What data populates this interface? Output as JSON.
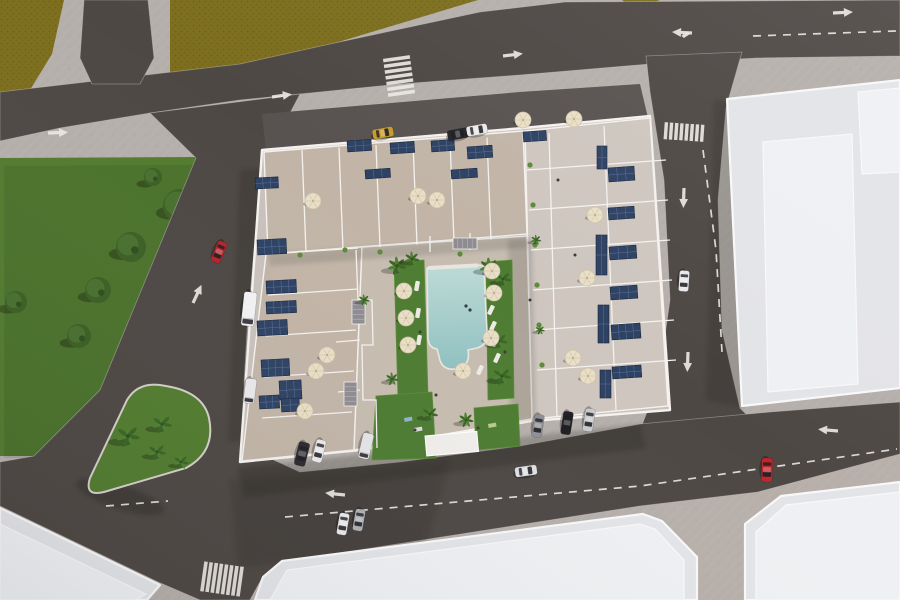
{
  "meta": {
    "type": "aerial-3d-architectural-render",
    "subject": "bird's-eye render of a residential apartment complex with rooftop solar panels, terraces, central pool courtyard, surrounding streets, parks and neighboring white buildings",
    "canvas": {
      "w": 900,
      "h": 600
    }
  },
  "palette": {
    "sidewalk": "#b5afab",
    "sidewalk_warm": "rgba(208,182,166,0.12)",
    "field": "#7d6f1e",
    "field_dark": "#6c6016",
    "park": "#527c30",
    "road": "#4e4845",
    "road_light": "#585250",
    "marking": "#eae8e4",
    "roof": "#e3e4e8",
    "roof_light": "#eef0f3",
    "parapet": "#f8f8f9",
    "complex_base": "#c9c2bc",
    "terrace": "#c2b5a8",
    "terrace_light": "#cec6bf",
    "deck": "#c6bcb0",
    "wall": "#f4f1ee",
    "solar": "#2e4263",
    "solar_line": "#5f77a0",
    "pool_light": "#bedad7",
    "pool_deep": "#8fc0c0",
    "lawn": "#4e7c32",
    "lawn_light": "#5c8b3a",
    "umbrella": "#e9dfc8",
    "umbrella_rib": "#d8cbae",
    "tree": "#3c6024",
    "tree_light": "#497030",
    "palm": "#4e8132",
    "palm_dark": "#3c6526"
  },
  "ground": {
    "fields": [
      "0,0 64,0 52,54 30,90 0,97",
      "170,0 478,0 332,44 250,64 196,76 170,82",
      "622,0 660,0 634,10"
    ],
    "park": "0,158 197,157 100,390 34,456 0,456",
    "trees": [
      [
        180,
        206,
        17
      ],
      [
        131,
        247,
        15
      ],
      [
        98,
        290,
        13
      ],
      [
        79,
        336,
        12
      ],
      [
        16,
        302,
        11
      ],
      [
        153,
        177,
        9
      ]
    ],
    "island": "M209,418 Q216,452 186,468 L104,492 Q84,497 90,478 L127,400 Q139,380 166,386 Q203,392 209,418 Z",
    "island_palms": [
      [
        128,
        436,
        1.25
      ],
      [
        162,
        424,
        1.05
      ],
      [
        157,
        452,
        0.95
      ],
      [
        181,
        462,
        0.8
      ]
    ],
    "warm_tint": "640,455 900,405 900,600 700,600"
  },
  "roads": {
    "surfaces": [
      "0,92 240,64 330,44 480,12 565,2 900,0 900,56 757,58 650,64 520,75 400,84 300,94 240,100 150,113 60,128 0,141",
      "84,0 148,0 154,58 140,84 92,84 80,58",
      "646,56 742,52 726,108 718,200 722,330 740,408 760,428 700,436 640,430 658,384 670,300 664,180 650,92",
      "150,113 196,158 100,390 34,456 0,462 0,506 158,582 200,600 250,600 262,578 282,562 640,506 758,492 900,454 900,402 770,412 640,424 520,446 400,462 300,472 252,450 243,400 247,330 254,250 268,155 300,94"
    ],
    "aprons": [
      "262,114 520,92 640,84 648,118 525,131 266,152"
    ],
    "dashes": [
      "M753,36 L896,31",
      "M703,150 L716,250 L722,352",
      "M285,517 L640,486 L897,449",
      "M106,506 L168,501"
    ],
    "arrows": [
      {
        "x": 48,
        "y": 133,
        "r": -2,
        "t": "s"
      },
      {
        "x": 272,
        "y": 97,
        "r": -8,
        "t": "s"
      },
      {
        "x": 503,
        "y": 56,
        "r": -7,
        "t": "s"
      },
      {
        "x": 833,
        "y": 13,
        "r": -3,
        "t": "s"
      },
      {
        "x": 692,
        "y": 33,
        "r": 183,
        "t": "f"
      },
      {
        "x": 258,
        "y": 186,
        "r": -65,
        "t": "s"
      },
      {
        "x": 193,
        "y": 303,
        "r": -65,
        "t": "s"
      },
      {
        "x": 684,
        "y": 188,
        "r": 92,
        "t": "s"
      },
      {
        "x": 688,
        "y": 352,
        "r": 92,
        "t": "s"
      },
      {
        "x": 345,
        "y": 495,
        "r": 186,
        "t": "s"
      },
      {
        "x": 838,
        "y": 431,
        "r": 185,
        "t": "s"
      }
    ],
    "crosswalks": [
      {
        "x": 399,
        "y": 76,
        "r": -8,
        "n": 7,
        "bl": 27,
        "bw": 3.6,
        "g": 2.2,
        "o": "h"
      },
      {
        "x": 684,
        "y": 132,
        "r": 4,
        "n": 8,
        "bl": 17,
        "bw": 3.4,
        "g": 1.8,
        "o": "v"
      },
      {
        "x": 222,
        "y": 579,
        "r": 8,
        "n": 8,
        "bl": 30,
        "bw": 3.6,
        "g": 1.6,
        "o": "v"
      }
    ]
  },
  "buildings": [
    {
      "id": "east-building",
      "pts": "727,99 900,80 900,388 742,406",
      "inner": [
        "763,142 852,134 858,384 768,392",
        "858,92 900,88 900,172 862,174"
      ]
    },
    {
      "id": "southwest-building",
      "pts": "0,508 160,585 147,600 0,600",
      "inner": [
        "0,524 146,594 136,600 0,600"
      ]
    },
    {
      "id": "south-building",
      "pts": "255,600 263,577 282,561 643,514 662,521 697,557 697,600",
      "inner": [
        "270,600 287,570 640,524 655,529 684,560 684,600"
      ]
    },
    {
      "id": "southeast-building",
      "pts": "745,524 781,496 900,482 900,600 745,600",
      "inner": [
        "756,532 786,505 900,492 900,600 756,600"
      ]
    }
  ],
  "complex": {
    "footprint": "262,150 523,128 650,116 670,410 532,421 360,450 240,462",
    "blocks": [
      {
        "pts": "264,152 523,131 527,234 268,254",
        "fill": "terrace"
      },
      {
        "pts": "266,254 362,247 354,450 242,461",
        "fill": "terrace"
      },
      {
        "pts": "525,131 650,118 668,406 532,419",
        "fill": "terrace_light"
      },
      {
        "pts": "362,247 527,236 532,419 354,450",
        "fill": "deck"
      }
    ],
    "inner_shadows": [
      {
        "pts": "508,240 532,238 536,420 510,422",
        "o": 0.14
      },
      {
        "pts": "268,254 527,236 528,248 270,266",
        "o": 0.13
      }
    ],
    "wall_runs": [
      {
        "x1": 302,
        "y1": 150,
        "x2": 306,
        "y2": 252,
        "n": 6,
        "dx": 37,
        "dy": -2.5
      },
      {
        "x1": 268,
        "y1": 295,
        "x2": 358,
        "y2": 289,
        "n": 4,
        "dx": -2,
        "dy": 41
      },
      {
        "x1": 527,
        "y1": 170,
        "x2": 666,
        "y2": 160,
        "n": 6,
        "dx": 2,
        "dy": 40
      },
      {
        "x1": 549,
        "y1": 133,
        "x2": 557,
        "y2": 417,
        "n": 1,
        "dx": 0,
        "dy": 0
      },
      {
        "x1": 604,
        "y1": 126,
        "x2": 616,
        "y2": 410,
        "n": 1,
        "dx": 0,
        "dy": 0
      }
    ],
    "wall_paths": [
      "M356,250 L358,300 L372,300 L373,345 L362,345 L363,400 L376,400 L377,448",
      "M268,254 L358,248",
      "M430,236 L430,252 M470,233 L470,250",
      "M360,340 L336,342 M360,390 L338,392"
    ],
    "solar_panels": [
      [
        347,
        141,
        24,
        11,
        -4
      ],
      [
        390,
        143,
        24,
        11,
        -4
      ],
      [
        431,
        141,
        23,
        11,
        -4
      ],
      [
        467,
        147,
        25,
        12,
        -4
      ],
      [
        365,
        170,
        25,
        9,
        -4
      ],
      [
        451,
        170,
        26,
        9,
        -4
      ],
      [
        255,
        178,
        23,
        11,
        -3
      ],
      [
        257,
        240,
        29,
        15,
        -3
      ],
      [
        266,
        281,
        30,
        13,
        -3
      ],
      [
        266,
        302,
        30,
        12,
        -3
      ],
      [
        257,
        321,
        30,
        15,
        -3
      ],
      [
        261,
        360,
        28,
        17,
        -3
      ],
      [
        279,
        381,
        22,
        19,
        -3
      ],
      [
        259,
        396,
        20,
        13,
        -3
      ],
      [
        281,
        399,
        18,
        13,
        -3
      ],
      [
        608,
        168,
        26,
        14,
        -4
      ],
      [
        608,
        208,
        26,
        12,
        -4
      ],
      [
        609,
        247,
        27,
        13,
        -4
      ],
      [
        610,
        287,
        27,
        13,
        -4
      ],
      [
        611,
        325,
        29,
        15,
        -4
      ],
      [
        612,
        367,
        29,
        12,
        -4
      ],
      [
        597,
        146,
        10,
        23,
        0
      ],
      [
        596,
        235,
        11,
        40,
        0
      ],
      [
        598,
        305,
        11,
        38,
        0
      ],
      [
        600,
        370,
        11,
        28,
        0
      ],
      [
        523,
        132,
        23,
        10,
        -4
      ]
    ],
    "umbrellas": [
      [
        313,
        201
      ],
      [
        418,
        196
      ],
      [
        437,
        200
      ],
      [
        492,
        271
      ],
      [
        327,
        355
      ],
      [
        316,
        371
      ],
      [
        305,
        411
      ],
      [
        523,
        120
      ],
      [
        574,
        119
      ],
      [
        595,
        215
      ],
      [
        587,
        278
      ],
      [
        573,
        358
      ],
      [
        588,
        376
      ],
      [
        404,
        291
      ],
      [
        406,
        318
      ],
      [
        408,
        345
      ],
      [
        494,
        293
      ],
      [
        491,
        338
      ],
      [
        463,
        371
      ]
    ],
    "palms": [
      [
        397,
        266,
        1
      ],
      [
        412,
        259,
        0.8
      ],
      [
        489,
        267,
        1
      ],
      [
        503,
        279,
        0.85
      ],
      [
        499,
        341,
        0.9
      ],
      [
        502,
        376,
        1
      ],
      [
        430,
        414,
        0.85
      ],
      [
        466,
        420,
        0.8
      ],
      [
        392,
        379,
        0.7
      ],
      [
        364,
        300,
        0.6
      ],
      [
        536,
        240,
        0.55
      ],
      [
        540,
        330,
        0.5
      ]
    ],
    "plants": [
      [
        530,
        165
      ],
      [
        533,
        205
      ],
      [
        535,
        245
      ],
      [
        537,
        285
      ],
      [
        539,
        325
      ],
      [
        542,
        365
      ],
      [
        300,
        255
      ],
      [
        345,
        250
      ],
      [
        380,
        252
      ],
      [
        460,
        254
      ]
    ],
    "lawns": [
      "394,262 424,260 428,396 398,398",
      "486,262 512,260 514,398 488,400",
      "376,396 432,392 436,458 372,460",
      "474,408 518,404 520,446 476,450"
    ],
    "pool": {
      "path": "M427,268 L479,265 Q484,265 484,270 L487,332 Q488,345 477,348 L468,350 Q471,366 456,369 Q441,371 439,356 L437,349 Q429,348 428,339 Z",
      "swimmers": [
        [
          466,
          306
        ],
        [
          470,
          310
        ]
      ]
    },
    "bench": [
      428,
      266,
      50,
      4,
      -3
    ],
    "loungers": [
      [
        489,
        294,
        115
      ],
      [
        491,
        310,
        115
      ],
      [
        493,
        326,
        115
      ],
      [
        495,
        342,
        115
      ],
      [
        497,
        358,
        115
      ],
      [
        417,
        286,
        100
      ],
      [
        418,
        313,
        100
      ],
      [
        419,
        340,
        100
      ],
      [
        480,
        370,
        115
      ]
    ],
    "kiosk": [
      425,
      436,
      52,
      20,
      -5
    ],
    "stairs": [
      [
        352,
        300,
        13,
        24
      ],
      [
        344,
        382,
        13,
        24
      ],
      [
        453,
        238,
        24,
        11
      ]
    ],
    "people": [
      [
        420,
        332
      ],
      [
        436,
        395
      ],
      [
        505,
        352
      ],
      [
        415,
        430
      ],
      [
        478,
        428
      ],
      [
        530,
        300
      ],
      [
        558,
        180
      ],
      [
        575,
        255
      ]
    ],
    "playthings": [
      [
        404,
        418,
        "#8fb3c9"
      ],
      [
        414,
        428,
        "#d9d9d9"
      ],
      [
        488,
        424,
        "#b7c98f"
      ]
    ]
  },
  "vehicles": [
    {
      "x": 219,
      "y": 252,
      "r": 113,
      "c": "#b6242a",
      "l": 22,
      "w": 10
    },
    {
      "x": 684,
      "y": 281,
      "r": 94,
      "c": "#e9e9ec",
      "l": 21,
      "w": 10
    },
    {
      "x": 383,
      "y": 133,
      "r": -10,
      "c": "#c79b2e",
      "l": 21,
      "w": 10
    },
    {
      "x": 458,
      "y": 134,
      "r": -10,
      "c": "#26262b",
      "l": 21,
      "w": 10
    },
    {
      "x": 477,
      "y": 130,
      "r": -10,
      "c": "#e9e9ec",
      "l": 21,
      "w": 10
    },
    {
      "x": 249,
      "y": 309,
      "r": 96,
      "c": "#f2f2f4",
      "l": 34,
      "w": 13,
      "van": true
    },
    {
      "x": 250,
      "y": 391,
      "r": 97,
      "c": "#e9e9ec",
      "l": 25,
      "w": 11,
      "van": true
    },
    {
      "x": 302,
      "y": 454,
      "r": 104,
      "c": "#2b2b30",
      "l": 24,
      "w": 11
    },
    {
      "x": 319,
      "y": 451,
      "r": 104,
      "c": "#e9e9ec",
      "l": 23,
      "w": 10
    },
    {
      "x": 366,
      "y": 446,
      "r": 103,
      "c": "#e3e4e6",
      "l": 26,
      "w": 11,
      "van": true
    },
    {
      "x": 538,
      "y": 426,
      "r": 99,
      "c": "#8f9095",
      "l": 23,
      "w": 10
    },
    {
      "x": 567,
      "y": 423,
      "r": 99,
      "c": "#1f1f24",
      "l": 23,
      "w": 10
    },
    {
      "x": 589,
      "y": 420,
      "r": 99,
      "c": "#c9cacd",
      "l": 23,
      "w": 10
    },
    {
      "x": 343,
      "y": 524,
      "r": 100,
      "c": "#e9e9ec",
      "l": 22,
      "w": 10
    },
    {
      "x": 359,
      "y": 520,
      "r": 100,
      "c": "#aeb0b4",
      "l": 22,
      "w": 10
    },
    {
      "x": 526,
      "y": 471,
      "r": -8,
      "c": "#dfe0e3",
      "l": 22,
      "w": 10
    },
    {
      "x": 767,
      "y": 470,
      "r": 92,
      "c": "#c0272d",
      "l": 24,
      "w": 11
    }
  ],
  "shadows": {
    "polys": [
      {
        "pts": "240,170 262,168 250,440 228,442",
        "o": 0.2,
        "b": 2
      },
      {
        "pts": "238,468 640,424 646,448 244,498",
        "o": 0.22,
        "b": 2
      },
      {
        "pts": "230,480 450,460 425,548 238,568",
        "o": 0.16,
        "b": 3
      },
      {
        "pts": "714,100 731,100 744,408 706,400",
        "o": 0.18,
        "b": 2
      }
    ],
    "ellipses": [
      {
        "cx": 120,
        "cy": 497,
        "rx": 46,
        "ry": 12,
        "rot": 18,
        "o": 0.28,
        "b": 2
      }
    ]
  }
}
